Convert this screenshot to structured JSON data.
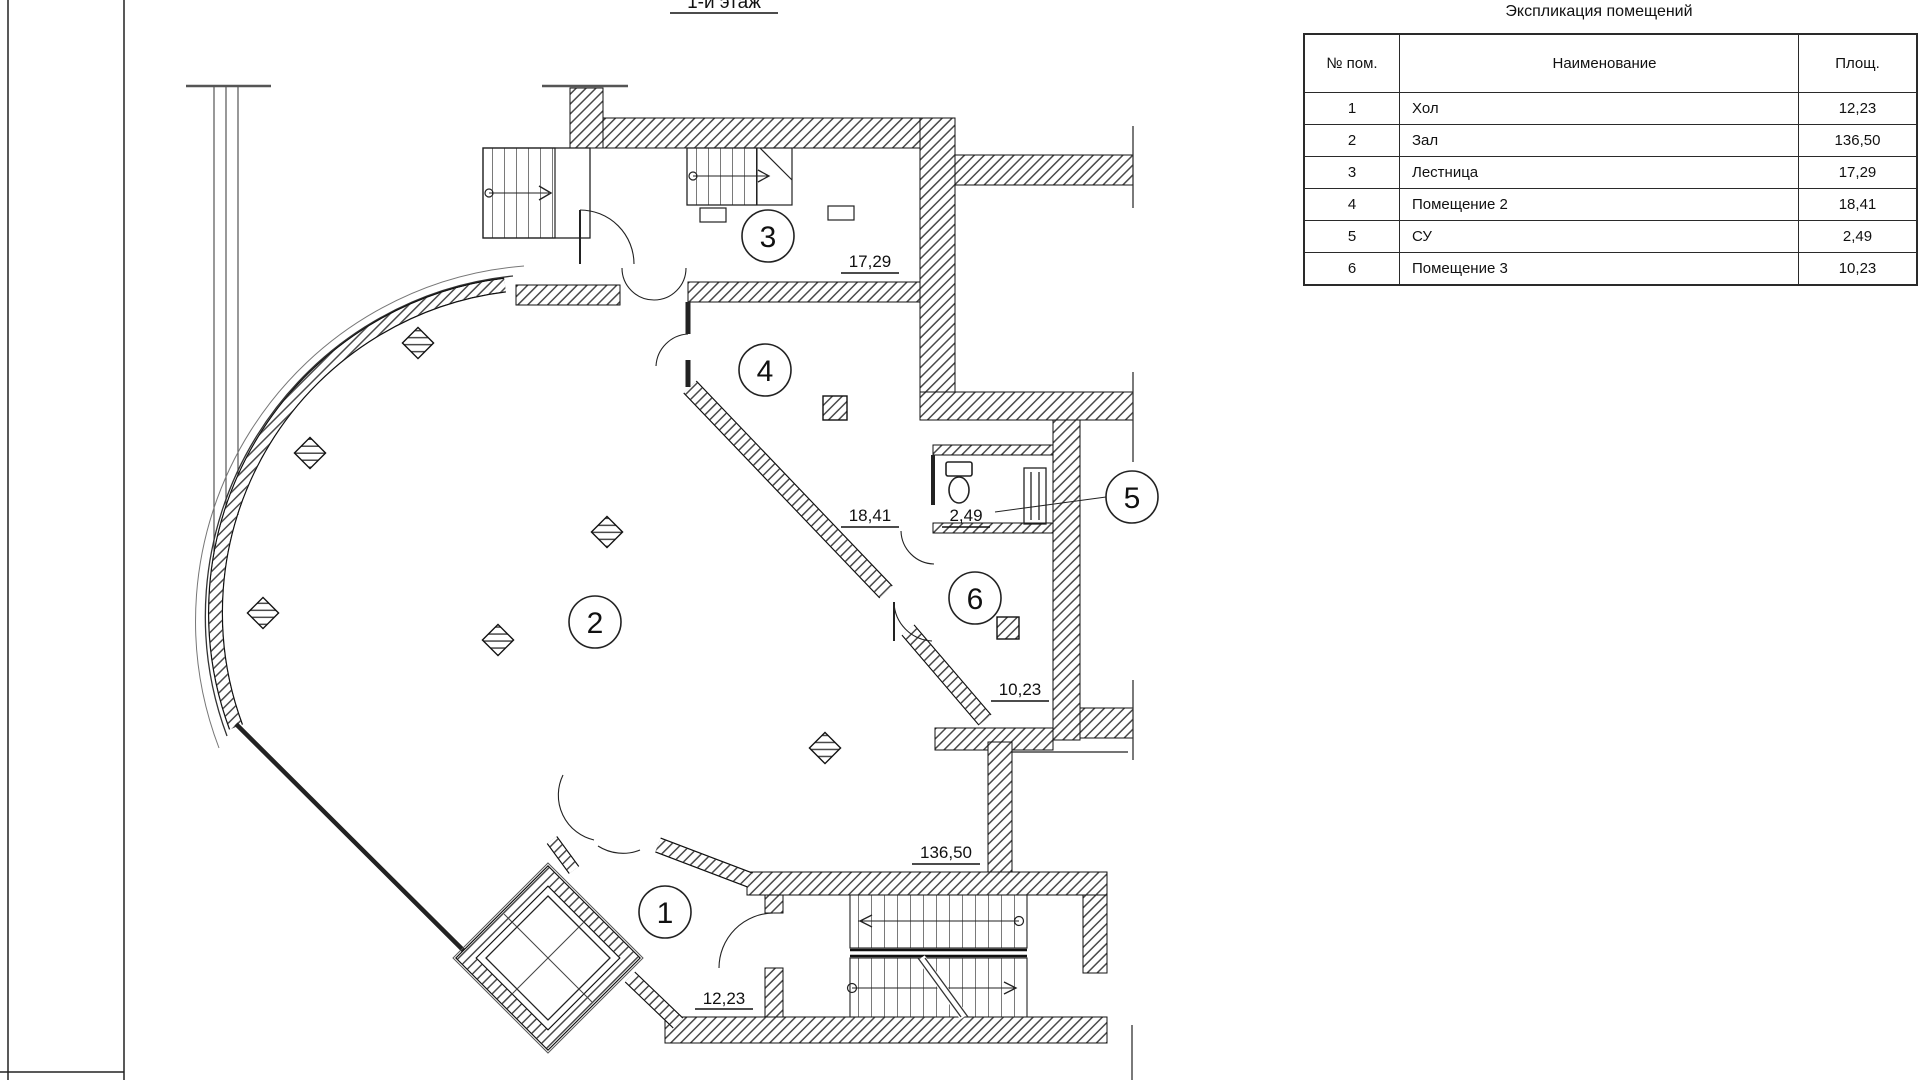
{
  "sheet": {
    "floor_title": "1-й этаж"
  },
  "table": {
    "title": "Экспликация помещений",
    "columns": [
      "№ пом.",
      "Наименование",
      "Площ."
    ],
    "rows": [
      {
        "num": "1",
        "name": "Хол",
        "area": "12,23"
      },
      {
        "num": "2",
        "name": "Зал",
        "area": "136,50"
      },
      {
        "num": "3",
        "name": "Лестница",
        "area": "17,29"
      },
      {
        "num": "4",
        "name": "Помещение 2",
        "area": "18,41"
      },
      {
        "num": "5",
        "name": "СУ",
        "area": "2,49"
      },
      {
        "num": "6",
        "name": "Помещение 3",
        "area": "10,23"
      }
    ]
  },
  "plan": {
    "rooms": [
      {
        "number": "1",
        "area_label": "12,23"
      },
      {
        "number": "2",
        "area_label": "136,50"
      },
      {
        "number": "3",
        "area_label": "17,29"
      },
      {
        "number": "4",
        "area_label": "18,41"
      },
      {
        "number": "5",
        "area_label": "2,49"
      },
      {
        "number": "6",
        "area_label": "10,23"
      }
    ]
  },
  "colors": {
    "line": "#1a1a1a",
    "hatch": "#4a4a4a",
    "background": "#ffffff"
  }
}
